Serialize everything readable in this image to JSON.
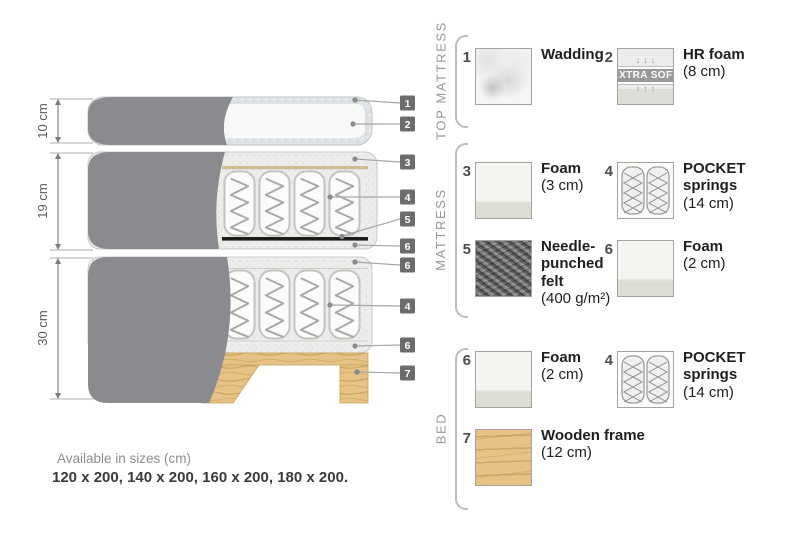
{
  "colors": {
    "cover_gray": "#8A8B8F",
    "chip_bg": "#6B6C6E",
    "wood": "#E6C385",
    "felt_dark": "#5E5E5E",
    "wadding_blue": "#DDE2E5",
    "muted_text": "#8E8E8E"
  },
  "diagram": {
    "dimensions": [
      {
        "label": "10 cm"
      },
      {
        "label": "19 cm"
      },
      {
        "label": "30 cm"
      }
    ],
    "callouts": [
      "1",
      "2",
      "3",
      "4",
      "5",
      "6",
      "6",
      "4",
      "6",
      "7"
    ]
  },
  "legend": {
    "sections": [
      {
        "label": "TOP MATTRESS",
        "items": [
          {
            "num": "1",
            "name": "Wadding",
            "size": ""
          },
          {
            "num": "2",
            "name": "HR foam",
            "size": "(8 cm)",
            "badge": "EXTRA SOFT",
            "arrows_down": "↓↓↓",
            "arrows_up": "↑↑↑"
          }
        ]
      },
      {
        "label": "MATTRESS",
        "items": [
          {
            "num": "3",
            "name": "Foam",
            "size": "(3 cm)"
          },
          {
            "num": "4",
            "name": "POCKET springs",
            "size": "(14 cm)"
          },
          {
            "num": "5",
            "name": "Needle-punched felt",
            "size": "(400 g/m²)"
          },
          {
            "num": "6",
            "name": "Foam",
            "size": "(2 cm)"
          }
        ]
      },
      {
        "label": "BED",
        "items": [
          {
            "num": "6",
            "name": "Foam",
            "size": "(2 cm)"
          },
          {
            "num": "4",
            "name": "POCKET springs",
            "size": "(14 cm)"
          },
          {
            "num": "7",
            "name": "Wooden frame",
            "size": "(12 cm)"
          }
        ]
      }
    ]
  },
  "footer": {
    "sizes_title": "Available in sizes (cm)",
    "sizes_values": "120 x 200, 140 x 200, 160 x 200, 180 x 200."
  }
}
